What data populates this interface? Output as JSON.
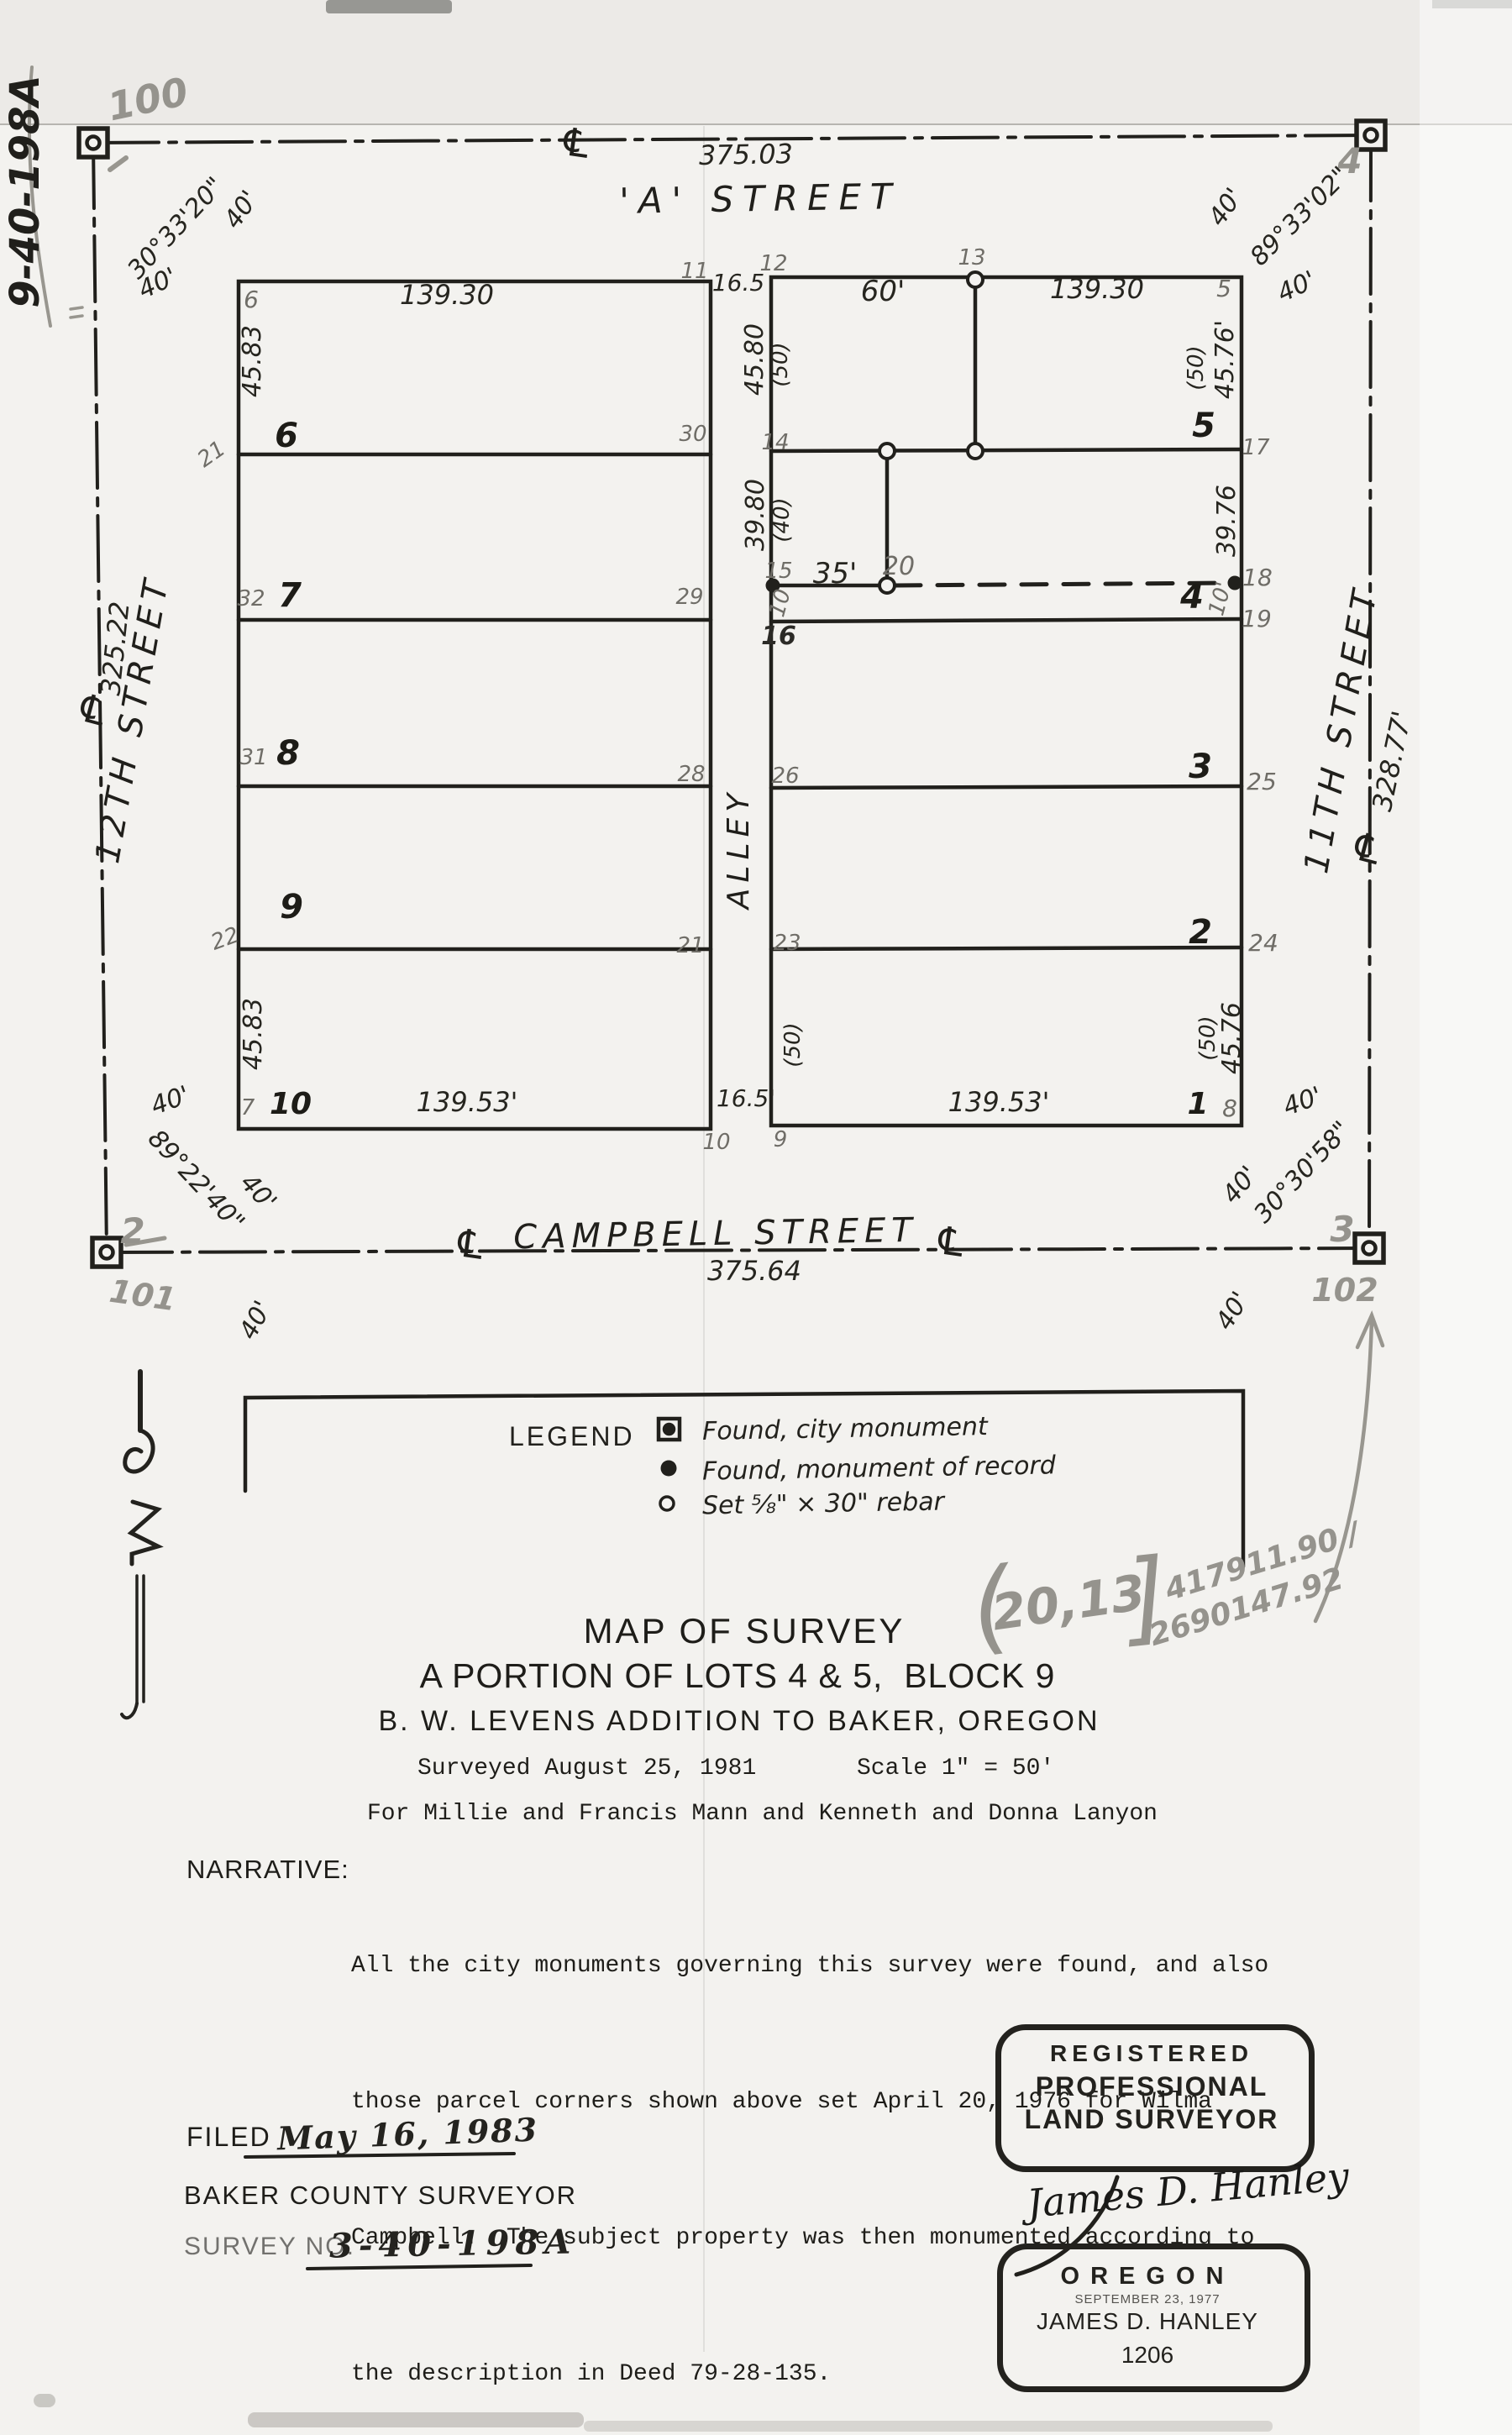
{
  "map_labels": {
    "ref-100": "100",
    "margin-file-ref": "9-40-198A",
    "cl-top": "℄",
    "dim-a-street": "375.03",
    "street-a": "'A'  STREET",
    "angle-nw": "30°33'20\"",
    "forty-nw-a": "40'",
    "forty-nw-b": "40'",
    "ref-4": "4",
    "angle-ne": "89°33'02\"",
    "forty-ne-a": "40'",
    "forty-ne-b": "40'",
    "p6": "6",
    "dim-top-left": "139.30",
    "p11": "11",
    "dim-alley-top": "16.5",
    "p12": "12",
    "p13": "13",
    "dim-60": "60'",
    "dim-top-right": "139.30",
    "p5": "5",
    "d-4583-t": "45.83",
    "d-4580": "45.80",
    "d-50-a": "(50)",
    "d-50-b": "(50)",
    "d-4576-t": "45.76'",
    "lot-6": "6",
    "p21": "21",
    "p30": "30",
    "p14": "14",
    "lot-5": "5",
    "p17": "17",
    "d-3980": "39.80",
    "d-40p": "(40)",
    "d-3976": "39.76",
    "lot-7": "7",
    "p32": "32",
    "p29": "29",
    "p15": "15",
    "dim-35": "35'",
    "p20": "20",
    "d-10-w": "10",
    "p16": "16",
    "lot-4": "4",
    "d-10-e": "10'",
    "p18": "18",
    "p19": "19",
    "lot-8": "8",
    "p31": "31",
    "p28": "28",
    "p26": "26",
    "lot-3": "3",
    "p25": "25",
    "alley": "ALLEY",
    "lot-9": "9",
    "p22": "22",
    "p21-east": "21",
    "p23": "23",
    "lot-2": "2",
    "p24": "24",
    "d-4583-b": "45.83",
    "d-50-c": "(50)",
    "d-50-d": "(50)",
    "d-4576-b": "45.76",
    "lot-10": "10",
    "p7": "7",
    "dim-bot-left": "139.53'",
    "dim-alley-bot": "16.5'",
    "lot-1": "1",
    "p8": "8",
    "dim-bot-right": "139.53'",
    "p10-s": "10",
    "p9-s": "9",
    "forty-w": "40'",
    "street-12": "12TH STREET",
    "dim-12th": "325.22",
    "cl-left": "℄",
    "street-11": "11TH STREET",
    "dim-11th": "328.77'",
    "cl-right": "℄",
    "ref-2": "2",
    "ref-101": "101",
    "angle-sw": "89°22'40\"",
    "forty-sw-a": "40'",
    "forty-sw-b": "40'",
    "street-campbell": "CAMPBELL  STREET",
    "dim-campbell": "375.64",
    "cl-bot-w": "℄",
    "cl-bot-e": "℄",
    "ref-3": "3",
    "ref-102": "102",
    "angle-se": "30°30'58\"",
    "forty-se-a": "40'",
    "forty-se-b": "40'",
    "forty-se-c": "40'",
    "coord-bl": "(",
    "coord-digits": "20,13",
    "coord-br": "]",
    "coord-n": "417911.90 /",
    "coord-e": "2690147.92"
  },
  "legend": {
    "heading": "LEGEND",
    "items": [
      {
        "symbol": "found-city-monument",
        "text": "Found, city monument"
      },
      {
        "symbol": "found-monument-of-record",
        "text": "Found, monument of record"
      },
      {
        "symbol": "set-rebar",
        "text": "Set ⅝\" × 30\" rebar"
      }
    ]
  },
  "title_block": {
    "line1": "MAP OF SURVEY",
    "line2": "A PORTION OF LOTS 4 & 5,  BLOCK 9",
    "line3": "B. W. LEVENS ADDITION TO BAKER, OREGON",
    "surveyed": "Surveyed August 25, 1981",
    "scale": "Scale 1\" = 50'",
    "for_line": "For Millie and Francis Mann and Kenneth and Donna Lanyon"
  },
  "narrative": {
    "heading": "NARRATIVE:",
    "lines": [
      "All the city monuments governing this survey were found, and also",
      "those parcel corners shown above set April 20, 1976 for Wilma",
      "Campbell.  The subject property was then monumented according to",
      "the description in Deed 79-28-135."
    ]
  },
  "filed_block": {
    "filed_label": "FILED",
    "filed_date": "May 16, 1983",
    "county_line": "BAKER COUNTY SURVEYOR",
    "survey_no_label": "SURVEY NO.",
    "survey_no": "3-40-198A"
  },
  "stamp": {
    "line1": "REGISTERED",
    "line2": "PROFESSIONAL",
    "line3": "LAND SURVEYOR",
    "signature": "James D. Hanley",
    "state": "OREGON",
    "date": "SEPTEMBER 23, 1977",
    "name": "JAMES D. HANLEY",
    "number": "1206"
  }
}
